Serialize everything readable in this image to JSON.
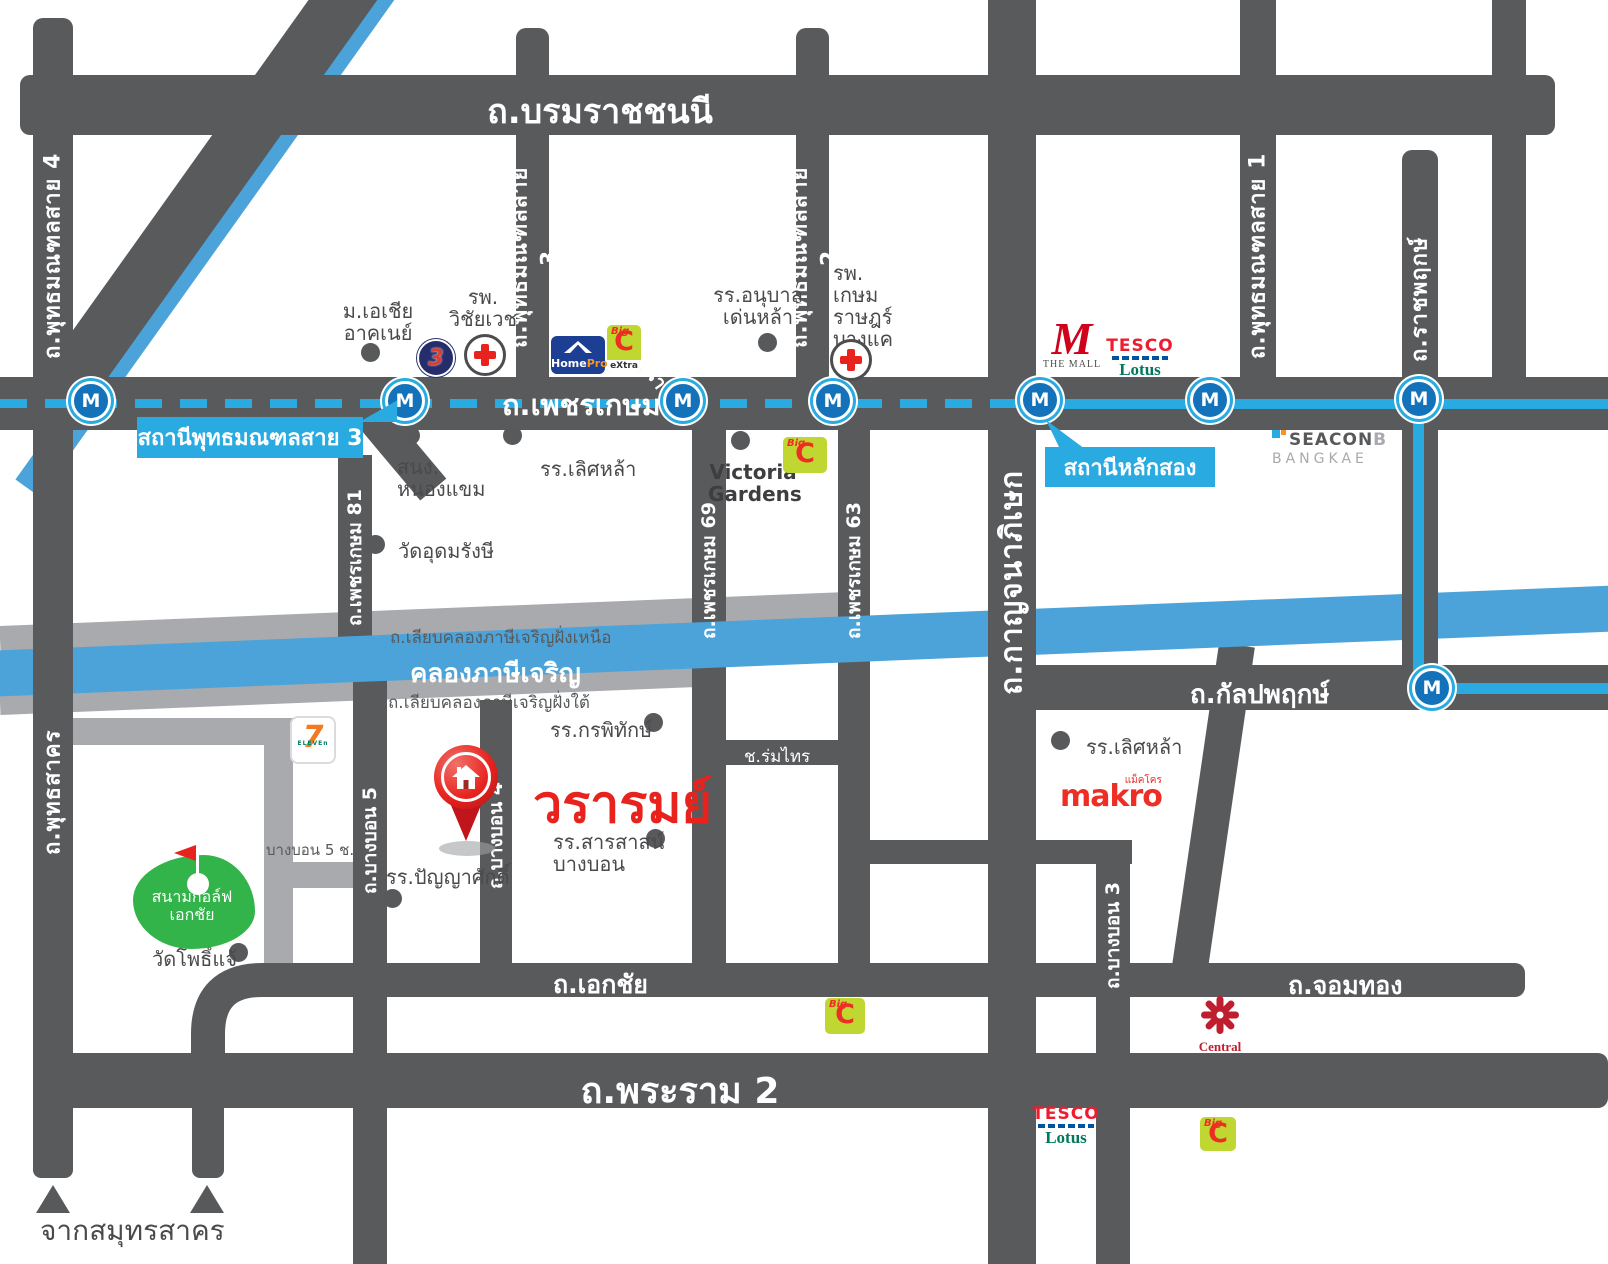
{
  "project": {
    "name": "วรารมย์"
  },
  "colors": {
    "road_dark": "#595A5C",
    "road_light": "#A8AAAD",
    "canal_blue": "#4BA3D9",
    "mrt_blue": "#29ABE2",
    "accent_red": "#E8231E",
    "golf_green": "#33B44A"
  },
  "roads": {
    "borommaratchachonnani": "ถ.บรมราชชนนี",
    "phetkasem": "ถ.เพชรเกษม",
    "phutthamonthon_sai4": "ถ.พุทธมณฑลสาย 4",
    "phutthamonthon_sai3": "ถ.พุทธมณฑลสาย 3",
    "phutthamonthon_sai2": "ถ.พุทธมณฑลสาย 2",
    "phutthamonthon_sai1": "ถ.พุทธมณฑลสาย 1",
    "ratchaphruek": "ถ.ราชพฤกษ์",
    "liap_khlong_thawi_watthana": "ถ.เลียบคลองทวีวัฒนา",
    "kanchanaphisek": "ถ.กาญจนาภิเษก",
    "phetkasem_81": "ถ.เพชรเกษม 81",
    "phetkasem_69": "ถ.เพชรเกษม 69",
    "phetkasem_63": "ถ.เพชรเกษม 63",
    "liap_khlong_nuea": "ถ.เลียบคลองภาษีเจริญฝั่งเหนือ",
    "liap_khlong_tai": "ถ.เลียบคลองภาษีเจริญฝั่งใต้",
    "phuttha_sakhon": "ถ.พุทธสาคร",
    "bang_bon_5": "ถ.บางบอน 5",
    "bang_bon_4": "ถ.บางบอน 4",
    "bang_bon_3": "ถ.บางบอน 3",
    "bang_bon_1": "ถ.บางบอน 1",
    "bang_bon_5_soi_5": "บางบอน 5 ช.5",
    "soi_rom_sai": "ช.ร่มไทร",
    "kanlapaphruek": "ถ.กัลปพฤกษ์",
    "ekkachai": "ถ.เอกชัย",
    "chom_thong": "ถ.จอมทอง",
    "rama_2": "ถ.พระราม 2"
  },
  "canal": {
    "name": "คลองภาษีเจริญ"
  },
  "mrt": {
    "letter": "M",
    "station_phutthamonthon_sai3": "สถานีพุทธมณฑลสาย 3",
    "station_lak_song": "สถานีหลักสอง"
  },
  "places": {
    "asia_university": "ม.เอเชีย\nอาคเนย์",
    "wichaivej_hospital": "รพ.\nวิชัยเวช",
    "anuban_denla_school": "รร.อนุบาล\nเด่นหล้า",
    "kasemrad_bangkhae_hospital": "รพ.\nเกษมราษฎร์\nบางแค",
    "nong_khaem_district_office": "สนง.\nหนองแขม",
    "lertlah_school_phetkasem": "รร.เลิศหล้า",
    "wat_udom_rangsi": "วัดอุดมรังษี",
    "victoria_gardens": "Victoria\nGardens",
    "kornpitack_school": "รร.กรพิทักษ์",
    "sarasas_bangbon_school": "รร.สารสาสน์\nบางบอน",
    "panyasak_school": "รร.ปัญญาศักดิ์",
    "lertlah_school_kanlapaphruek": "รร.เลิศหล้า",
    "ekachai_golf_course": "สนามกอล์ฟ\nเอกชัย",
    "wat_pho_chae": "วัดโพธิ์แจ้"
  },
  "logos": {
    "seven_eleven": {
      "seven": "7",
      "eleven": "ELEVEn"
    },
    "channel3": {
      "digit": "3"
    },
    "homepro": {
      "home": "Home",
      "pro": "Pro"
    },
    "bigc": {
      "big": "Big",
      "c": "C",
      "extra": "eXtra"
    },
    "the_mall": {
      "m": "M",
      "text": "THE MALL"
    },
    "tesco_lotus": {
      "tesco": "TESCO",
      "lotus": "Lotus"
    },
    "seacon": {
      "line1_bold": "SEACON",
      "line1_light": "B",
      "line2": "BANGKAE"
    },
    "makro": {
      "latin": "makro",
      "thai": "แม็คโคร"
    },
    "central": {
      "text": "Central"
    }
  },
  "notes": {
    "from_samut_sakhon": "จากสมุทรสาคร"
  }
}
